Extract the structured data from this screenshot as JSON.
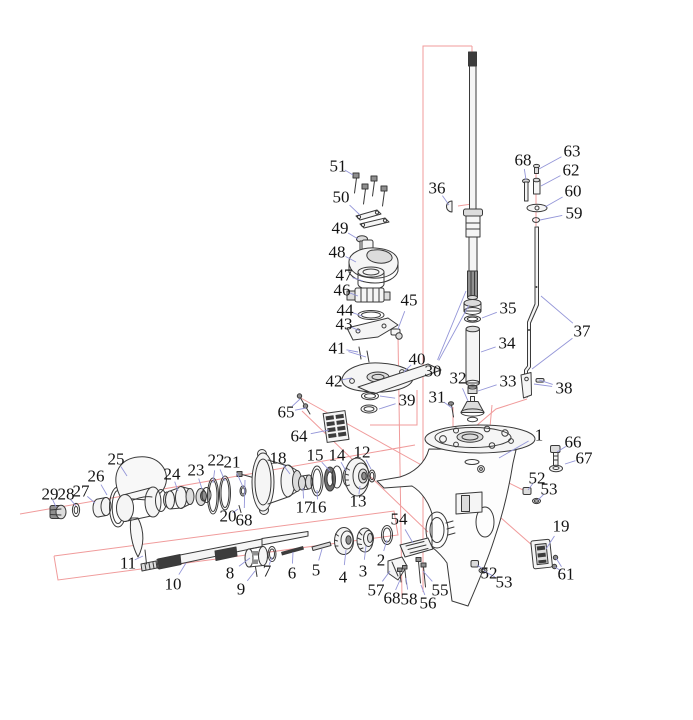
{
  "diagram": {
    "subject": "Outboard motor lower unit gearcase exploded parts diagram",
    "canvas": {
      "width": 693,
      "height": 720
    },
    "style": {
      "ink": "#3a3a3a",
      "leader_color": "#9496d8",
      "red_color": "#f09b9b",
      "label_color": "#141414",
      "label_font_size": 17
    },
    "part_labels": [
      {
        "text": "51",
        "x": 338,
        "y": 166,
        "leads": [
          [
            353,
            175
          ]
        ]
      },
      {
        "text": "50",
        "x": 341,
        "y": 197,
        "leads": [
          [
            360,
            215
          ]
        ]
      },
      {
        "text": "49",
        "x": 340,
        "y": 228,
        "leads": [
          [
            358,
            239
          ]
        ]
      },
      {
        "text": "48",
        "x": 337,
        "y": 252,
        "leads": [
          [
            356,
            262
          ]
        ]
      },
      {
        "text": "47",
        "x": 344,
        "y": 275,
        "leads": [
          [
            363,
            281
          ]
        ]
      },
      {
        "text": "46",
        "x": 342,
        "y": 290,
        "leads": [
          [
            358,
            296
          ]
        ]
      },
      {
        "text": "44",
        "x": 345,
        "y": 310,
        "leads": [
          [
            362,
            316
          ]
        ]
      },
      {
        "text": "43",
        "x": 344,
        "y": 324,
        "leads": [
          [
            360,
            331
          ]
        ]
      },
      {
        "text": "41",
        "x": 337,
        "y": 348,
        "leads": [
          [
            358,
            352
          ],
          [
            366,
            357
          ]
        ]
      },
      {
        "text": "42",
        "x": 334,
        "y": 381,
        "leads": [
          [
            352,
            378
          ]
        ]
      },
      {
        "text": "45",
        "x": 409,
        "y": 300,
        "leads": [
          [
            398,
            329
          ]
        ]
      },
      {
        "text": "40",
        "x": 417,
        "y": 359,
        "leads": [
          [
            404,
            372
          ]
        ]
      },
      {
        "text": "39",
        "x": 407,
        "y": 400,
        "leads": [
          [
            380,
            396
          ],
          [
            379,
            409
          ]
        ]
      },
      {
        "text": "36",
        "x": 437,
        "y": 188,
        "leads": [
          [
            449,
            205
          ]
        ]
      },
      {
        "text": "65",
        "x": 286,
        "y": 412,
        "leads": [
          [
            300,
            399
          ],
          [
            306,
            408
          ]
        ]
      },
      {
        "text": "64",
        "x": 299,
        "y": 436,
        "leads": [
          [
            329,
            430
          ]
        ]
      },
      {
        "text": "68",
        "x": 523,
        "y": 160,
        "leads": [
          [
            526,
            180
          ]
        ]
      },
      {
        "text": "63",
        "x": 572,
        "y": 151,
        "leads": [
          [
            539,
            169
          ]
        ]
      },
      {
        "text": "62",
        "x": 571,
        "y": 170,
        "leads": [
          [
            541,
            186
          ]
        ]
      },
      {
        "text": "60",
        "x": 573,
        "y": 191,
        "leads": [
          [
            545,
            207
          ]
        ]
      },
      {
        "text": "59",
        "x": 574,
        "y": 213,
        "leads": [
          [
            540,
            220
          ]
        ]
      },
      {
        "text": "37",
        "x": 582,
        "y": 331,
        "leads": [
          [
            541,
            296
          ],
          [
            532,
            369
          ]
        ]
      },
      {
        "text": "38",
        "x": 564,
        "y": 388,
        "leads": [
          [
            534,
            384
          ],
          [
            539,
            380
          ]
        ]
      },
      {
        "text": "35",
        "x": 508,
        "y": 308,
        "leads": [
          [
            482,
            318
          ]
        ]
      },
      {
        "text": "34",
        "x": 507,
        "y": 343,
        "leads": [
          [
            481,
            352
          ]
        ]
      },
      {
        "text": "33",
        "x": 508,
        "y": 381,
        "leads": [
          [
            478,
            391
          ]
        ]
      },
      {
        "text": "32",
        "x": 458,
        "y": 378,
        "leads": [
          [
            468,
            401
          ]
        ]
      },
      {
        "text": "31",
        "x": 437,
        "y": 397,
        "leads": [
          [
            452,
            408
          ]
        ]
      },
      {
        "text": "30",
        "x": 433,
        "y": 371,
        "leads": [
          [
            466,
            291
          ],
          [
            469,
            305
          ]
        ]
      },
      {
        "text": "1",
        "x": 539,
        "y": 435,
        "leads": [
          [
            499,
            458
          ]
        ]
      },
      {
        "text": "66",
        "x": 573,
        "y": 442,
        "leads": [
          [
            557,
            452
          ]
        ]
      },
      {
        "text": "67",
        "x": 584,
        "y": 458,
        "leads": [
          [
            565,
            464
          ]
        ]
      },
      {
        "text": "52",
        "x": 537,
        "y": 478,
        "leads": [
          [
            528,
            490
          ]
        ]
      },
      {
        "text": "53",
        "x": 549,
        "y": 489,
        "leads": [
          [
            538,
            500
          ]
        ]
      },
      {
        "text": "19",
        "x": 561,
        "y": 526,
        "leads": [
          [
            546,
            549
          ]
        ]
      },
      {
        "text": "61",
        "x": 566,
        "y": 574,
        "leads": [
          [
            556,
            558
          ],
          [
            555,
            567
          ]
        ]
      },
      {
        "text": "52",
        "x": 489,
        "y": 573,
        "leads": [
          [
            477,
            565
          ]
        ]
      },
      {
        "text": "53",
        "x": 504,
        "y": 582,
        "leads": [
          [
            484,
            571
          ]
        ]
      },
      {
        "text": "54",
        "x": 399,
        "y": 519,
        "leads": [
          [
            413,
            543
          ]
        ]
      },
      {
        "text": "55",
        "x": 440,
        "y": 590,
        "leads": [
          [
            423,
            571
          ]
        ]
      },
      {
        "text": "56",
        "x": 428,
        "y": 603,
        "leads": [
          [
            421,
            585
          ]
        ]
      },
      {
        "text": "58",
        "x": 409,
        "y": 599,
        "leads": [
          [
            406,
            578
          ]
        ]
      },
      {
        "text": "68",
        "x": 392,
        "y": 598,
        "leads": [
          [
            400,
            580
          ]
        ]
      },
      {
        "text": "57",
        "x": 376,
        "y": 590,
        "leads": [
          [
            390,
            571
          ]
        ]
      },
      {
        "text": "18",
        "x": 278,
        "y": 458,
        "leads": [
          [
            290,
            474
          ]
        ]
      },
      {
        "text": "15",
        "x": 315,
        "y": 455,
        "leads": [
          [
            330,
            471
          ]
        ]
      },
      {
        "text": "14",
        "x": 337,
        "y": 455,
        "leads": [
          [
            346,
            471
          ]
        ]
      },
      {
        "text": "12",
        "x": 362,
        "y": 452,
        "leads": [
          [
            371,
            469
          ]
        ]
      },
      {
        "text": "13",
        "x": 358,
        "y": 501,
        "leads": [
          [
            360,
            486
          ]
        ]
      },
      {
        "text": "17",
        "x": 304,
        "y": 507,
        "leads": [
          [
            303,
            488
          ]
        ]
      },
      {
        "text": "16",
        "x": 318,
        "y": 507,
        "leads": [
          [
            317,
            490
          ]
        ]
      },
      {
        "text": "22",
        "x": 216,
        "y": 460,
        "leads": [
          [
            213,
            483
          ],
          [
            225,
            481
          ]
        ]
      },
      {
        "text": "21",
        "x": 232,
        "y": 462,
        "leads": [
          [
            243,
            487
          ]
        ]
      },
      {
        "text": "23",
        "x": 196,
        "y": 470,
        "leads": [
          [
            202,
            489
          ]
        ]
      },
      {
        "text": "24",
        "x": 172,
        "y": 474,
        "leads": [
          [
            178,
            491
          ]
        ]
      },
      {
        "text": "25",
        "x": 116,
        "y": 459,
        "leads": [
          [
            127,
            476
          ]
        ]
      },
      {
        "text": "26",
        "x": 96,
        "y": 476,
        "leads": [
          [
            107,
            495
          ]
        ]
      },
      {
        "text": "27",
        "x": 81,
        "y": 491,
        "leads": [
          [
            95,
            503
          ]
        ]
      },
      {
        "text": "28",
        "x": 66,
        "y": 494,
        "leads": [
          [
            76,
            506
          ]
        ]
      },
      {
        "text": "29",
        "x": 50,
        "y": 494,
        "leads": [
          [
            56,
            507
          ]
        ]
      },
      {
        "text": "20",
        "x": 228,
        "y": 516,
        "leads": [
          [
            238,
            509
          ]
        ]
      },
      {
        "text": "68",
        "x": 244,
        "y": 520,
        "leads": [
          [
            245,
            480
          ]
        ]
      },
      {
        "text": "11",
        "x": 128,
        "y": 563,
        "leads": [
          [
            143,
            556
          ]
        ]
      },
      {
        "text": "10",
        "x": 173,
        "y": 584,
        "leads": [
          [
            186,
            563
          ]
        ]
      },
      {
        "text": "8",
        "x": 230,
        "y": 573,
        "leads": [
          [
            250,
            558
          ]
        ]
      },
      {
        "text": "9",
        "x": 241,
        "y": 589,
        "leads": [
          [
            255,
            571
          ]
        ]
      },
      {
        "text": "7",
        "x": 267,
        "y": 571,
        "leads": [
          [
            272,
            557
          ]
        ]
      },
      {
        "text": "6",
        "x": 292,
        "y": 573,
        "leads": [
          [
            293,
            552
          ]
        ]
      },
      {
        "text": "5",
        "x": 316,
        "y": 570,
        "leads": [
          [
            322,
            549
          ]
        ]
      },
      {
        "text": "4",
        "x": 343,
        "y": 577,
        "leads": [
          [
            346,
            550
          ]
        ]
      },
      {
        "text": "3",
        "x": 363,
        "y": 571,
        "leads": [
          [
            366,
            546
          ]
        ]
      },
      {
        "text": "2",
        "x": 381,
        "y": 560,
        "leads": [
          [
            387,
            540
          ]
        ]
      }
    ],
    "red_reference_lines": [
      {
        "points": [
          [
            472,
            46
          ],
          [
            423,
            46
          ],
          [
            423,
            592
          ]
        ]
      },
      {
        "points": [
          [
            398,
            336
          ],
          [
            402,
            598
          ]
        ]
      },
      {
        "points": [
          [
            536,
            167
          ],
          [
            536,
            226
          ]
        ]
      },
      {
        "points": [
          [
            527,
            399
          ],
          [
            496,
            409
          ],
          [
            469,
            432
          ]
        ]
      },
      {
        "points": [
          [
            20,
            514
          ],
          [
            415,
            445
          ]
        ]
      },
      {
        "points": [
          [
            54,
            556
          ],
          [
            394,
            511
          ],
          [
            398,
            535
          ],
          [
            58,
            580
          ],
          [
            54,
            556
          ]
        ]
      },
      {
        "points": [
          [
            299,
            397
          ],
          [
            434,
            472
          ]
        ]
      },
      {
        "points": [
          [
            302,
            411
          ],
          [
            428,
            532
          ]
        ]
      },
      {
        "points": [
          [
            370,
            425
          ],
          [
            417,
            425
          ],
          [
            417,
            390
          ]
        ]
      },
      {
        "points": [
          [
            483,
            470
          ],
          [
            527,
            492
          ]
        ]
      },
      {
        "points": [
          [
            431,
            509
          ],
          [
            472,
            562
          ]
        ]
      },
      {
        "points": [
          [
            500,
            517
          ],
          [
            533,
            546
          ]
        ]
      },
      {
        "points": [
          [
            453,
            407
          ],
          [
            453,
            429
          ]
        ]
      },
      {
        "points": [
          [
            492,
            405
          ],
          [
            490,
            427
          ]
        ]
      },
      {
        "points": [
          [
            472,
            46
          ],
          [
            472,
            204
          ],
          [
            458,
            206
          ]
        ]
      }
    ]
  }
}
